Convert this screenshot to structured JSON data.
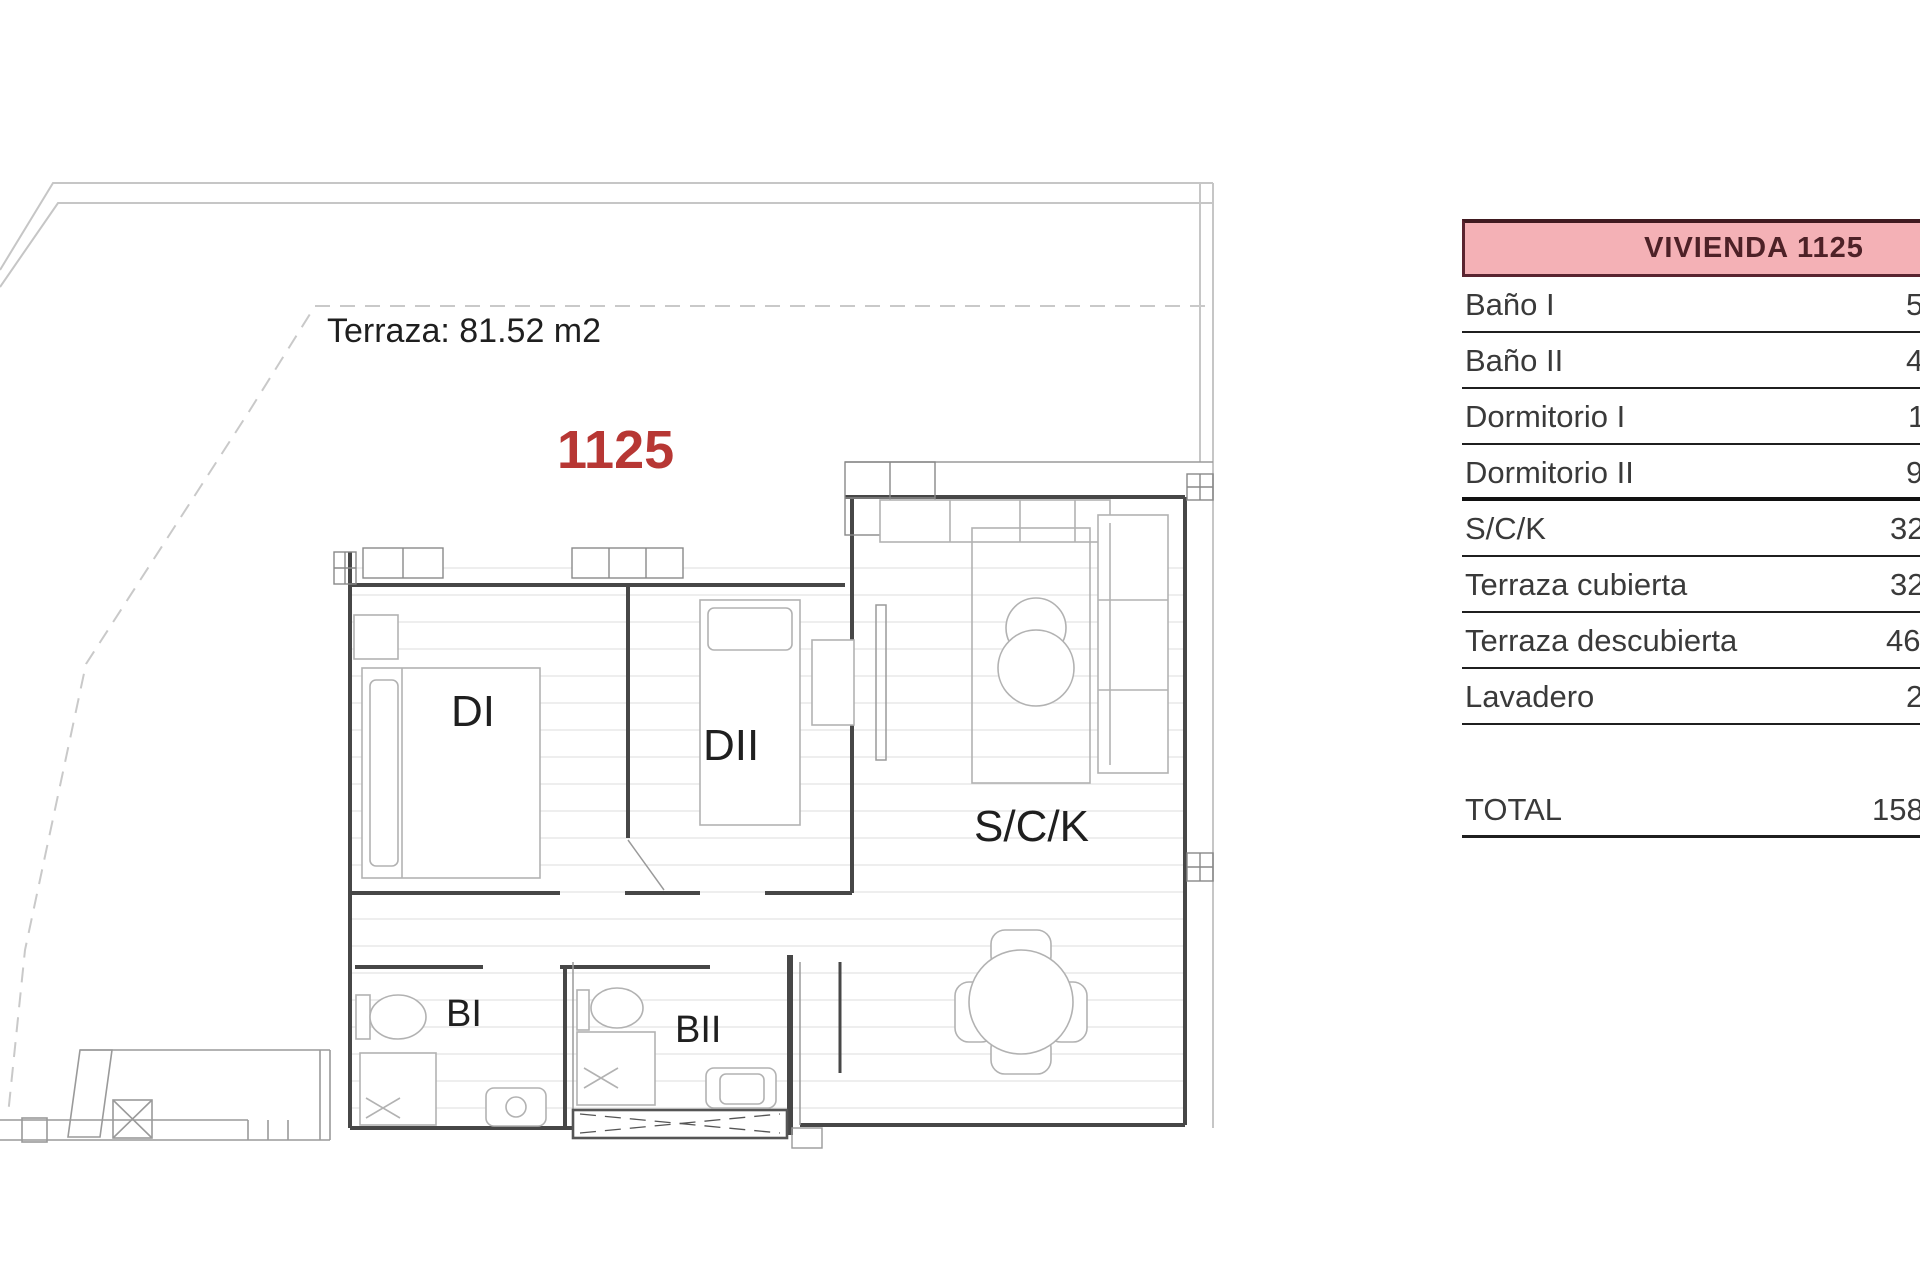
{
  "plan": {
    "terrace_area_label": "Terraza: 81.52 m2",
    "unit_number": "1125",
    "accent_red": "#b73734",
    "rooms": {
      "dormitorio1": "DI",
      "dormitorio2": "DII",
      "salon_cocina": "S/C/K",
      "bano1": "BI",
      "bano2": "BII"
    }
  },
  "table": {
    "header": "VIVIENDA 1125",
    "header_bg": "#f4b1b6",
    "header_border_color": "#5a2430",
    "header_text_color": "#4d2127",
    "rows": [
      {
        "label": "Baño I",
        "value": "5"
      },
      {
        "label": "Baño II",
        "value": "4"
      },
      {
        "label": "Dormitorio I",
        "value": "1"
      },
      {
        "label": "Dormitorio II",
        "value": "9"
      },
      {
        "label": "S/C/K",
        "value": "32"
      },
      {
        "label": "Terraza cubierta",
        "value": "32"
      },
      {
        "label": "Terraza descubierta",
        "value": "46"
      },
      {
        "label": "Lavadero",
        "value": "2"
      }
    ],
    "total": {
      "label": "TOTAL",
      "value": "158"
    }
  }
}
